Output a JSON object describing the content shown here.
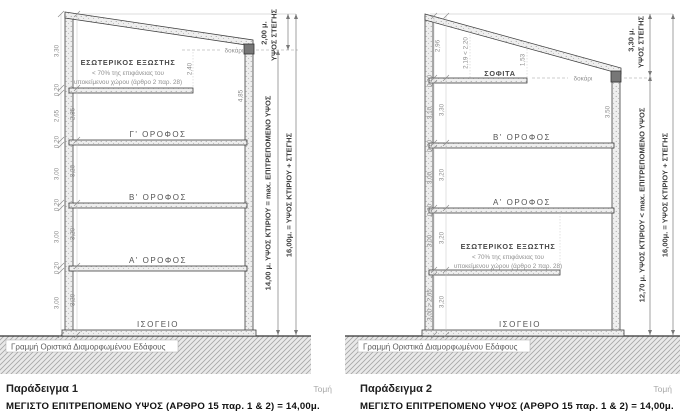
{
  "palette": {
    "ink": "#3f3f3f",
    "dim_text": "#8a8a8a",
    "hatch": "#a6a6a6"
  },
  "captions": {
    "ex1_title": "Παράδειγμα 1",
    "ex2_title": "Παράδειγμα 2",
    "section": "Τομή",
    "ex1_max": "ΜΕΓΙΣΤΟ ΕΠΙΤΡΕΠΟΜΕΝΟ ΥΨΟΣ (ΑΡΘΡΟ 15 παρ. 1 & 2) =  14,00μ.",
    "ex2_max": "ΜΕΓΙΣΤΟ ΕΠΙΤΡΕΠΟΜΕΝΟ ΥΨΟΣ (ΑΡΘΡΟ 15 παρ. 1 & 2) =  14,00μ."
  },
  "ex1": {
    "ground_label": "Γραμμή Οριστικά Διαμορφωμένου Εδάφους",
    "beam_label": "δοκάρι",
    "roof_height": "2,00 μ.",
    "roof_height_label": "ΥΨΟΣ ΣΤΕΓΗΣ",
    "building_height_label": "14,00 μ. ΥΨΟΣ ΚΤΙΡΙΟΥ = max. ΕΠΙΤΡΕΠΟΜΕΝΟ ΥΨΟΣ",
    "total_height_label": "16,00μ. = ΥΨΟΣ ΚΤΙΡΙΟΥ + ΣΤΕΓΗΣ",
    "loft_line1": "ΕΣΩΤΕΡΙΚΟΣ ΕΞΩΣΤΗΣ",
    "loft_line2": "< 70% της επιφάνειας του",
    "loft_line3": "υποκείμενου χώρου (άρθρο 2 παρ. 28)",
    "floor3": "Γ' ΟΡΟΦΟΣ",
    "floor2": "Β' ΟΡΟΦΟΣ",
    "floor1": "Α' ΟΡΟΦΟΣ",
    "floor0": "ΙΣΟΓΕΙΟ",
    "dims": {
      "top": "3,30",
      "loft": "2,40",
      "right": "4,85",
      "f3_slab": "0,20",
      "f3_clear": "2,65",
      "f3_total": "2,85",
      "f2_slab": "0,20",
      "f2_clear": "3,00",
      "f2_total": "3,20",
      "f1_slab": "0,20",
      "f1_clear": "3,00",
      "f1_total": "3,20",
      "f0_slab": "0,20",
      "f0_clear": "3,00",
      "f0_total": "3,20"
    }
  },
  "ex2": {
    "ground_label": "Γραμμή Οριστικά Διαμορφωμένου Εδάφους",
    "beam_label": "δοκάρι",
    "attic_label": "ΣΟΦΙΤΑ",
    "roof_height": "3,30 μ.",
    "roof_height_label": "ΥΨΟΣ ΣΤΕΓΗΣ",
    "building_height_label": "12,70 μ. ΥΨΟΣ ΚΤΙΡΙΟΥ < max. ΕΠΙΤΡΕΠΟΜΕΝΟ ΥΨΟΣ",
    "total_height_label": "16,00μ. = ΥΨΟΣ ΚΤΙΡΙΟΥ + ΣΤΕΓΗΣ",
    "loft_line1": "ΕΣΩΤΕΡΙΚΟΣ ΕΞΩΣΤΗΣ",
    "loft_line2": "< 70% της επιφάνειας του",
    "loft_line3": "υποκείμενου χώρου (άρθρο 2 παρ. 28)",
    "floor2": "Β' ΟΡΟΦΟΣ",
    "floor1": "Α' ΟΡΟΦΟΣ",
    "floor0": "ΙΣΟΓΕΙΟ",
    "dims": {
      "attic_left": "2,96",
      "attic_mid": "2,19 < 2,20",
      "attic_right": "1,53",
      "right_wall": "3,50",
      "f2_slab": "0,20",
      "f2_clear": "3,10",
      "f2_total": "3,30",
      "f1_slab": "0,20",
      "f1_clear": "3,00",
      "f1_total": "3,20",
      "g_up_slab": "0,20",
      "g_up_clear": "3,00",
      "g_up_total": "3,20",
      "g_low_clear": "3,00 > 2,65",
      "g_low_total": "3,20"
    }
  }
}
